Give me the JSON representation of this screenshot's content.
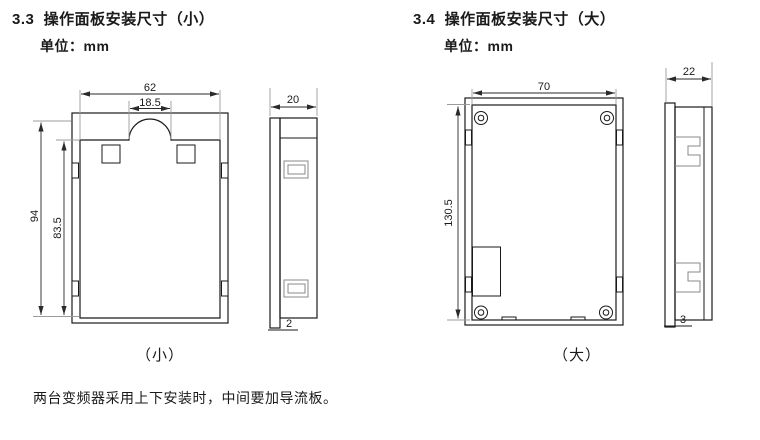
{
  "sections": {
    "small": {
      "heading": "3.3  操作面板安装尺寸（小）",
      "unit_label": "单位：mm",
      "caption": "（小）",
      "dims": {
        "overall_width": "62",
        "notch_width": "18.5",
        "overall_height": "94",
        "window_height": "83.5",
        "depth": "20",
        "flange_thickness": "2"
      }
    },
    "large": {
      "heading": "3.4  操作面板安装尺寸（大）",
      "unit_label": "单位：mm",
      "caption": "（大）",
      "dims": {
        "overall_width": "70",
        "overall_height": "130.5",
        "depth": "22",
        "flange_thickness": "3"
      }
    }
  },
  "note": "两台变频器采用上下安装时，中间要加导流板。",
  "colors": {
    "background": "#ffffff",
    "line": "#1a1a1a",
    "extension_line": "#9b9b9b"
  }
}
